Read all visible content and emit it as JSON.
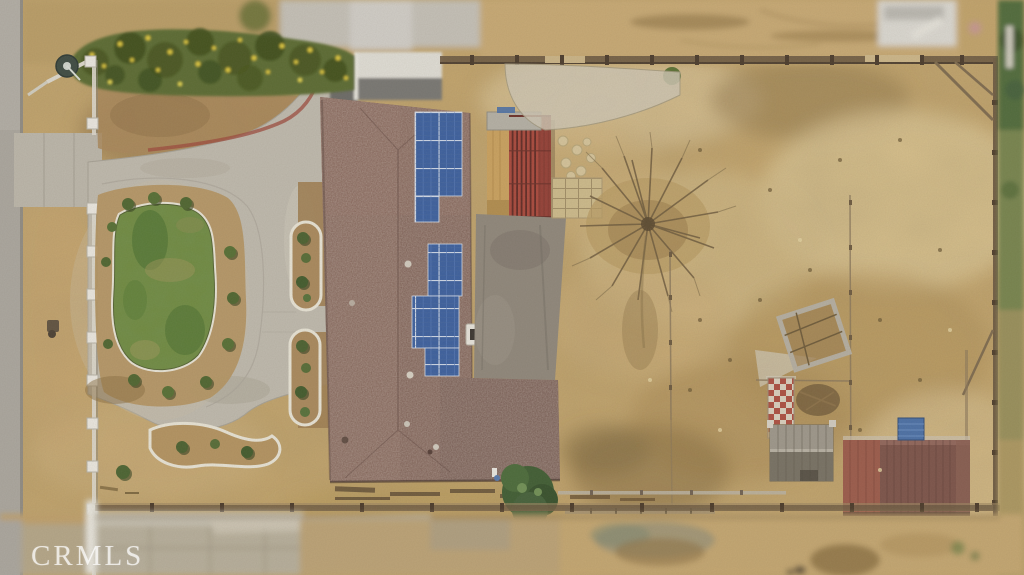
{
  "watermark": {
    "text": "CRMLS"
  },
  "scene": {
    "type": "aerial-drone-photo",
    "description": "Top-down aerial view of a residential property: house with rooftop solar panels, kidney-shaped lawn, concrete motor court and driveway, white front fence along a road, large dirt backyard with bare tree, sheds, tilted planter frame and checkered mat; tilt-shift blur at top and bottom edges",
    "elements": [
      "road",
      "parkway",
      "white-front-fence",
      "satellite-dish",
      "flower-hedge",
      "white-garage",
      "concrete-driveway",
      "red-brick-ribbon",
      "motor-court",
      "kidney-lawn",
      "shrub-ring",
      "garden-beds",
      "house-roof",
      "solar-panel-array",
      "roof-chimney",
      "red-pergola",
      "plywood-panel",
      "concrete-patio",
      "stepping-stones",
      "paver-pad",
      "gravel-patch",
      "bare-tree",
      "wire-fences",
      "tilted-planter-frame",
      "checkered-mat",
      "gray-shed",
      "garage-shed",
      "blue-tarp",
      "wood-perimeter-fence",
      "south-bush",
      "railroad-ties",
      "neighbor-white-shed",
      "mls-watermark"
    ]
  },
  "colors": {
    "road": "#a9a59d",
    "dirt": "#c2a46c",
    "sand_light": "#d9c291",
    "concrete": "#bdb8ac",
    "grass": "#6f8a40",
    "grass_dark": "#4a7030",
    "roof": "#7d5c53",
    "solar_blue": "#3b5f9e",
    "solar_frame": "#ccd6e6",
    "pergola_red": "#a8483c",
    "patio": "#8e867a",
    "hedge_green": "#5a6a31",
    "flower_yellow": "#dcc63e",
    "fence_white": "#e9e6df",
    "fence_wood": "#6b5941",
    "shed_gray": "#8b8578",
    "garage_roof": "#7b5349",
    "tarp_blue": "#4a6fa5",
    "gravel": "#ccc4b1",
    "watermark_color": "rgba(255,255,255,0.72)"
  }
}
